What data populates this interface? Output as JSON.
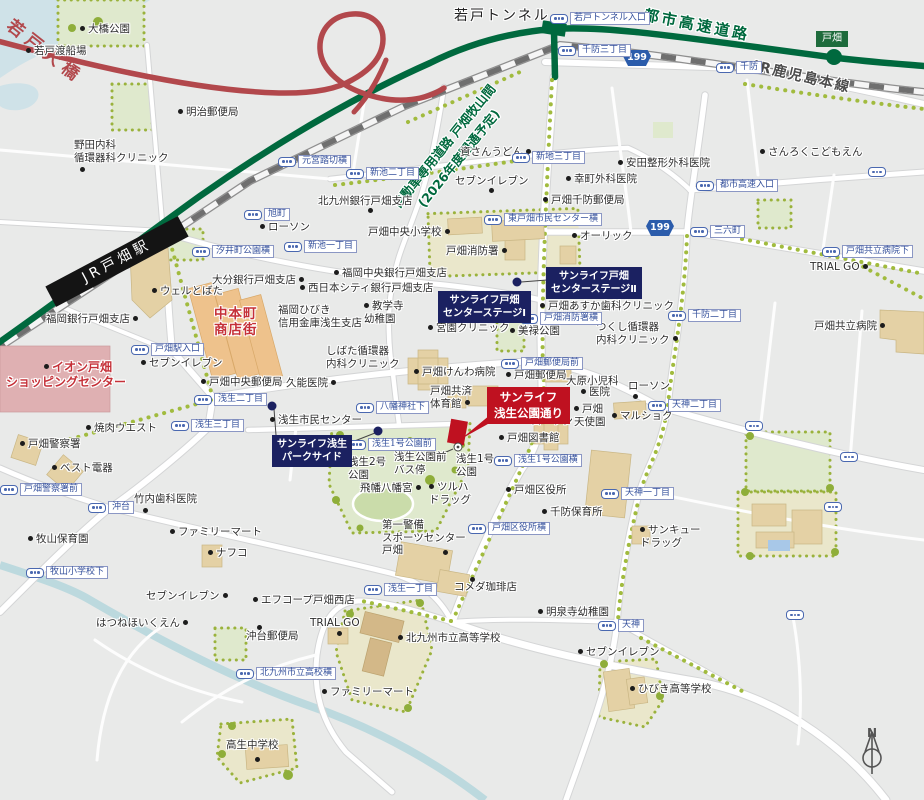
{
  "highlight_callout": {
    "line1": "サンライフ",
    "line2": "浅生公園通り"
  },
  "navy_callouts": {
    "center_stage_2": {
      "line1": "サンライフ戸畑",
      "line2": "センターステージⅡ"
    },
    "center_stage_1": {
      "line1": "サンライフ戸畑",
      "line2": "センターステージⅠ"
    },
    "park_side": {
      "line1": "サンライフ浅生",
      "line2": "パークサイド"
    }
  },
  "road_labels": {
    "wakato_bridge": "若戸大橋",
    "wakato_tunnel": "若戸トンネル",
    "urban_expressway": "都市高速道路",
    "jr_kagoshima_line": "JR鹿児島本線",
    "jr_tobata_station": "JR戸畑駅",
    "planned_road_line1": "自動車専用道路 戸畑牧山間",
    "planned_road_line2": "(2026年度開通予定)"
  },
  "badges": {
    "expressway_exit": "戸畑",
    "route_shield": "199"
  },
  "compass": {
    "label": "N"
  },
  "colors": {
    "highlight_red": "#bf1120",
    "sunlife_navy": "#1b2161",
    "expressway_green": "#00693e",
    "bridge_red": "#b2484c",
    "bus_blue": "#4a68b0",
    "park_green": "#dfe9cd",
    "building_tan": "#e4d1a5"
  },
  "icons": {
    "bus_stop": "bus-stop-pill-icon",
    "poi_dot": "poi-marker-dot",
    "compass": "compass-north-icon",
    "highlight_building": "highlight-building-marker"
  },
  "bus_stops": [
    {
      "t": "若戸トンネル入口",
      "x": 550,
      "y": 12
    },
    {
      "t": "千防三丁目",
      "x": 558,
      "y": 44
    },
    {
      "t": "千防",
      "x": 716,
      "y": 61
    },
    {
      "t": "新地三丁目",
      "x": 512,
      "y": 151
    },
    {
      "t": "元宮踏切横",
      "x": 278,
      "y": 155
    },
    {
      "t": "新池二丁目",
      "x": 346,
      "y": 167
    },
    {
      "t": "新池一丁目",
      "x": 284,
      "y": 240
    },
    {
      "t": "旭町",
      "x": 244,
      "y": 208
    },
    {
      "t": "汐井町公園横",
      "x": 192,
      "y": 245
    },
    {
      "t": "戸畑駅入口",
      "x": 131,
      "y": 343
    },
    {
      "t": "浅生二丁目",
      "x": 194,
      "y": 393
    },
    {
      "t": "浅生三丁目",
      "x": 171,
      "y": 419
    },
    {
      "t": "沖台",
      "x": 88,
      "y": 501
    },
    {
      "t": "戸畑警察署前",
      "x": 0,
      "y": 483
    },
    {
      "t": "牧山小学校下",
      "x": 26,
      "y": 566
    },
    {
      "t": "八幡神社下",
      "x": 356,
      "y": 401
    },
    {
      "t": "浅生1号公園前",
      "x": 348,
      "y": 438
    },
    {
      "t": "浅生1号公園横",
      "x": 494,
      "y": 454
    },
    {
      "t": "戸畑区役所横",
      "x": 468,
      "y": 522
    },
    {
      "t": "浅生一丁目",
      "x": 364,
      "y": 583
    },
    {
      "t": "東戸畑市民センター横",
      "x": 484,
      "y": 213
    },
    {
      "t": "戸畑消防署横",
      "x": 520,
      "y": 312
    },
    {
      "t": "戸畑郵便局前",
      "x": 501,
      "y": 357
    },
    {
      "t": "三六町",
      "x": 690,
      "y": 225
    },
    {
      "t": "都市高速入口",
      "x": 696,
      "y": 179
    },
    {
      "t": "千防二丁目",
      "x": 668,
      "y": 309
    },
    {
      "t": "戸畑共立病院下",
      "x": 822,
      "y": 245
    },
    {
      "t": "天神二丁目",
      "x": 648,
      "y": 399
    },
    {
      "t": "天神一丁目",
      "x": 601,
      "y": 487
    },
    {
      "t": "天神",
      "x": 598,
      "y": 619
    },
    {
      "t": "北九州市立高校横",
      "x": 236,
      "y": 667
    }
  ],
  "lone_bus_icons": [
    {
      "x": 745,
      "y": 421
    },
    {
      "x": 840,
      "y": 452
    },
    {
      "x": 824,
      "y": 502
    },
    {
      "x": 786,
      "y": 610
    },
    {
      "x": 868,
      "y": 167
    }
  ],
  "poi_dots": [
    {
      "x": 80,
      "y": 167
    },
    {
      "x": 489,
      "y": 188
    },
    {
      "x": 368,
      "y": 208
    },
    {
      "x": 443,
      "y": 550
    },
    {
      "x": 470,
      "y": 577
    },
    {
      "x": 255,
      "y": 757
    },
    {
      "x": 337,
      "y": 631
    },
    {
      "x": 257,
      "y": 625
    },
    {
      "x": 143,
      "y": 508
    },
    {
      "x": 633,
      "y": 394
    }
  ],
  "pois": [
    {
      "t": "大橋公園",
      "x": 80,
      "y": 23,
      "d": "l"
    },
    {
      "t": "若戸渡船場",
      "x": 26,
      "y": 45,
      "d": "l"
    },
    {
      "t": "明治郵便局",
      "x": 178,
      "y": 106,
      "d": "l"
    },
    {
      "t": [
        "野田内科",
        "循環器科クリニック"
      ],
      "x": 74,
      "y": 139,
      "d": "n"
    },
    {
      "t": "資さんうどん",
      "x": 460,
      "y": 146,
      "d": "r"
    },
    {
      "t": "セブンイレブン",
      "x": 455,
      "y": 175,
      "d": "n"
    },
    {
      "t": "幸町外科医院",
      "x": 566,
      "y": 173,
      "d": "l"
    },
    {
      "t": "安田整形外科医院",
      "x": 618,
      "y": 157,
      "d": "l"
    },
    {
      "t": "さんろくこどもえん",
      "x": 760,
      "y": 146,
      "d": "l"
    },
    {
      "t": "戸畑千防郵便局",
      "x": 543,
      "y": 194,
      "d": "l"
    },
    {
      "t": "オーリック",
      "x": 572,
      "y": 230,
      "d": "l"
    },
    {
      "t": "北九州銀行戸畑支店",
      "x": 318,
      "y": 195,
      "d": "n"
    },
    {
      "t": "戸畑中央小学校",
      "x": 368,
      "y": 226,
      "d": "r"
    },
    {
      "t": "戸畑消防署",
      "x": 446,
      "y": 245,
      "d": "r"
    },
    {
      "t": "福岡中央銀行戸畑支店",
      "x": 334,
      "y": 267,
      "d": "l"
    },
    {
      "t": "西日本シティ銀行戸畑支店",
      "x": 300,
      "y": 282,
      "d": "l"
    },
    {
      "t": [
        "教学寺",
        "幼稚園"
      ],
      "x": 364,
      "y": 300,
      "d": "l"
    },
    {
      "t": [
        "福岡ひびき",
        "信用金庫浅生支店"
      ],
      "x": 278,
      "y": 304,
      "d": "n"
    },
    {
      "t": "大分銀行戸畑支店",
      "x": 212,
      "y": 274,
      "d": "r"
    },
    {
      "t": "ローソン",
      "x": 260,
      "y": 221,
      "d": "l"
    },
    {
      "t": "ウェルとばた",
      "x": 152,
      "y": 285,
      "d": "l"
    },
    {
      "t": "福岡銀行戸畑支店",
      "x": 46,
      "y": 313,
      "d": "r"
    },
    {
      "t": "セブンイレブン",
      "x": 141,
      "y": 357,
      "d": "l"
    },
    {
      "t": "戸畑中央郵便局",
      "x": 201,
      "y": 376,
      "d": "l"
    },
    {
      "t": "久能医院",
      "x": 286,
      "y": 377,
      "d": "r"
    },
    {
      "t": "浅生市民センター",
      "x": 270,
      "y": 414,
      "d": "l"
    },
    {
      "t": [
        "しばた循環器",
        "内科クリニック"
      ],
      "x": 326,
      "y": 345,
      "d": "n"
    },
    {
      "t": "宮園クリニック",
      "x": 428,
      "y": 322,
      "d": "l"
    },
    {
      "t": "美禄公園",
      "x": 510,
      "y": 325,
      "d": "l"
    },
    {
      "t": "戸畑あすか歯科クリニック",
      "x": 540,
      "y": 300,
      "d": "l"
    },
    {
      "t": [
        "つくし循環器",
        "内科クリニック"
      ],
      "x": 596,
      "y": 321,
      "d": "r"
    },
    {
      "t": "戸畑けんわ病院",
      "x": 414,
      "y": 366,
      "d": "l"
    },
    {
      "t": "戸畑郵便局",
      "x": 506,
      "y": 369,
      "d": "l"
    },
    {
      "t": "大原小児科",
      "x": 566,
      "y": 375,
      "d": "n"
    },
    {
      "t": "医院",
      "x": 581,
      "y": 386,
      "d": "l"
    },
    {
      "t": "ローソン",
      "x": 628,
      "y": 380,
      "d": "n"
    },
    {
      "t": [
        "戸畑",
        "天使園"
      ],
      "x": 574,
      "y": 403,
      "d": "l"
    },
    {
      "t": "マルショク",
      "x": 612,
      "y": 410,
      "d": "l"
    },
    {
      "t": "戸畑図書館",
      "x": 499,
      "y": 432,
      "d": "l"
    },
    {
      "t": "ローソン",
      "x": 523,
      "y": 415,
      "d": "l"
    },
    {
      "t": [
        "ツルハ",
        "ドラッグ"
      ],
      "x": 429,
      "y": 481,
      "d": "l"
    },
    {
      "t": "飛幡八幡宮",
      "x": 360,
      "y": 482,
      "d": "r"
    },
    {
      "t": [
        "浅生2号",
        "公園"
      ],
      "x": 348,
      "y": 456,
      "d": "n"
    },
    {
      "t": [
        "浅生1号",
        "公園"
      ],
      "x": 456,
      "y": 453,
      "d": "n"
    },
    {
      "t": [
        "浅生公園前",
        "バス停"
      ],
      "x": 394,
      "y": 451,
      "d": "n"
    },
    {
      "t": "戸畑区役所",
      "x": 506,
      "y": 484,
      "d": "l"
    },
    {
      "t": "千防保育所",
      "x": 542,
      "y": 506,
      "d": "l"
    },
    {
      "t": [
        "第一警備",
        "スポーツセンター",
        "戸畑"
      ],
      "x": 382,
      "y": 519,
      "d": "n"
    },
    {
      "t": "コメダ珈琲店",
      "x": 454,
      "y": 581,
      "d": "n"
    },
    {
      "t": "明泉寺幼稚園",
      "x": 538,
      "y": 606,
      "d": "l"
    },
    {
      "t": "セブンイレブン",
      "x": 578,
      "y": 646,
      "d": "l"
    },
    {
      "t": "ひびき高等学校",
      "x": 630,
      "y": 683,
      "d": "l"
    },
    {
      "t": "高生中学校",
      "x": 226,
      "y": 739,
      "d": "n"
    },
    {
      "t": "北九州市立高等学校",
      "x": 398,
      "y": 632,
      "d": "l"
    },
    {
      "t": "ファミリーマート",
      "x": 170,
      "y": 526,
      "d": "l"
    },
    {
      "t": "ファミリーマート",
      "x": 322,
      "y": 686,
      "d": "l"
    },
    {
      "t": "ナフコ",
      "x": 208,
      "y": 547,
      "d": "l"
    },
    {
      "t": "竹内歯科医院",
      "x": 134,
      "y": 493,
      "d": "n"
    },
    {
      "t": "牧山保育園",
      "x": 28,
      "y": 533,
      "d": "l"
    },
    {
      "t": "焼肉ウエスト",
      "x": 86,
      "y": 422,
      "d": "l"
    },
    {
      "t": "戸畑警察署",
      "x": 20,
      "y": 438,
      "d": "l"
    },
    {
      "t": "ベスト電器",
      "x": 52,
      "y": 462,
      "d": "l"
    },
    {
      "t": "セブンイレブン",
      "x": 146,
      "y": 590,
      "d": "r"
    },
    {
      "t": "エフコープ戸畑西店",
      "x": 253,
      "y": 594,
      "d": "l"
    },
    {
      "t": "はつねほいくえん",
      "x": 96,
      "y": 617,
      "d": "r"
    },
    {
      "t": "沖台郵便局",
      "x": 246,
      "y": 630,
      "d": "n"
    },
    {
      "t": "TRIAL GO",
      "x": 810,
      "y": 261,
      "d": "r"
    },
    {
      "t": "TRIAL GO",
      "x": 310,
      "y": 617,
      "d": "n"
    },
    {
      "t": "戸畑共立病院",
      "x": 814,
      "y": 320,
      "d": "r"
    },
    {
      "t": [
        "サンキュー",
        "ドラッグ"
      ],
      "x": 640,
      "y": 524,
      "d": "l"
    },
    {
      "t": [
        "戸畑共済",
        "体育館"
      ],
      "x": 430,
      "y": 385,
      "d": "r"
    },
    {
      "t": "イオン戸畑",
      "x": 44,
      "y": 360,
      "d": "l",
      "c": "red"
    },
    {
      "t": "ショッピングセンター",
      "x": 6,
      "y": 375,
      "d": "n",
      "c": "red"
    },
    {
      "t": [
        "中本町",
        "商店街"
      ],
      "x": 214,
      "y": 306,
      "d": "n",
      "c": "red big"
    }
  ]
}
